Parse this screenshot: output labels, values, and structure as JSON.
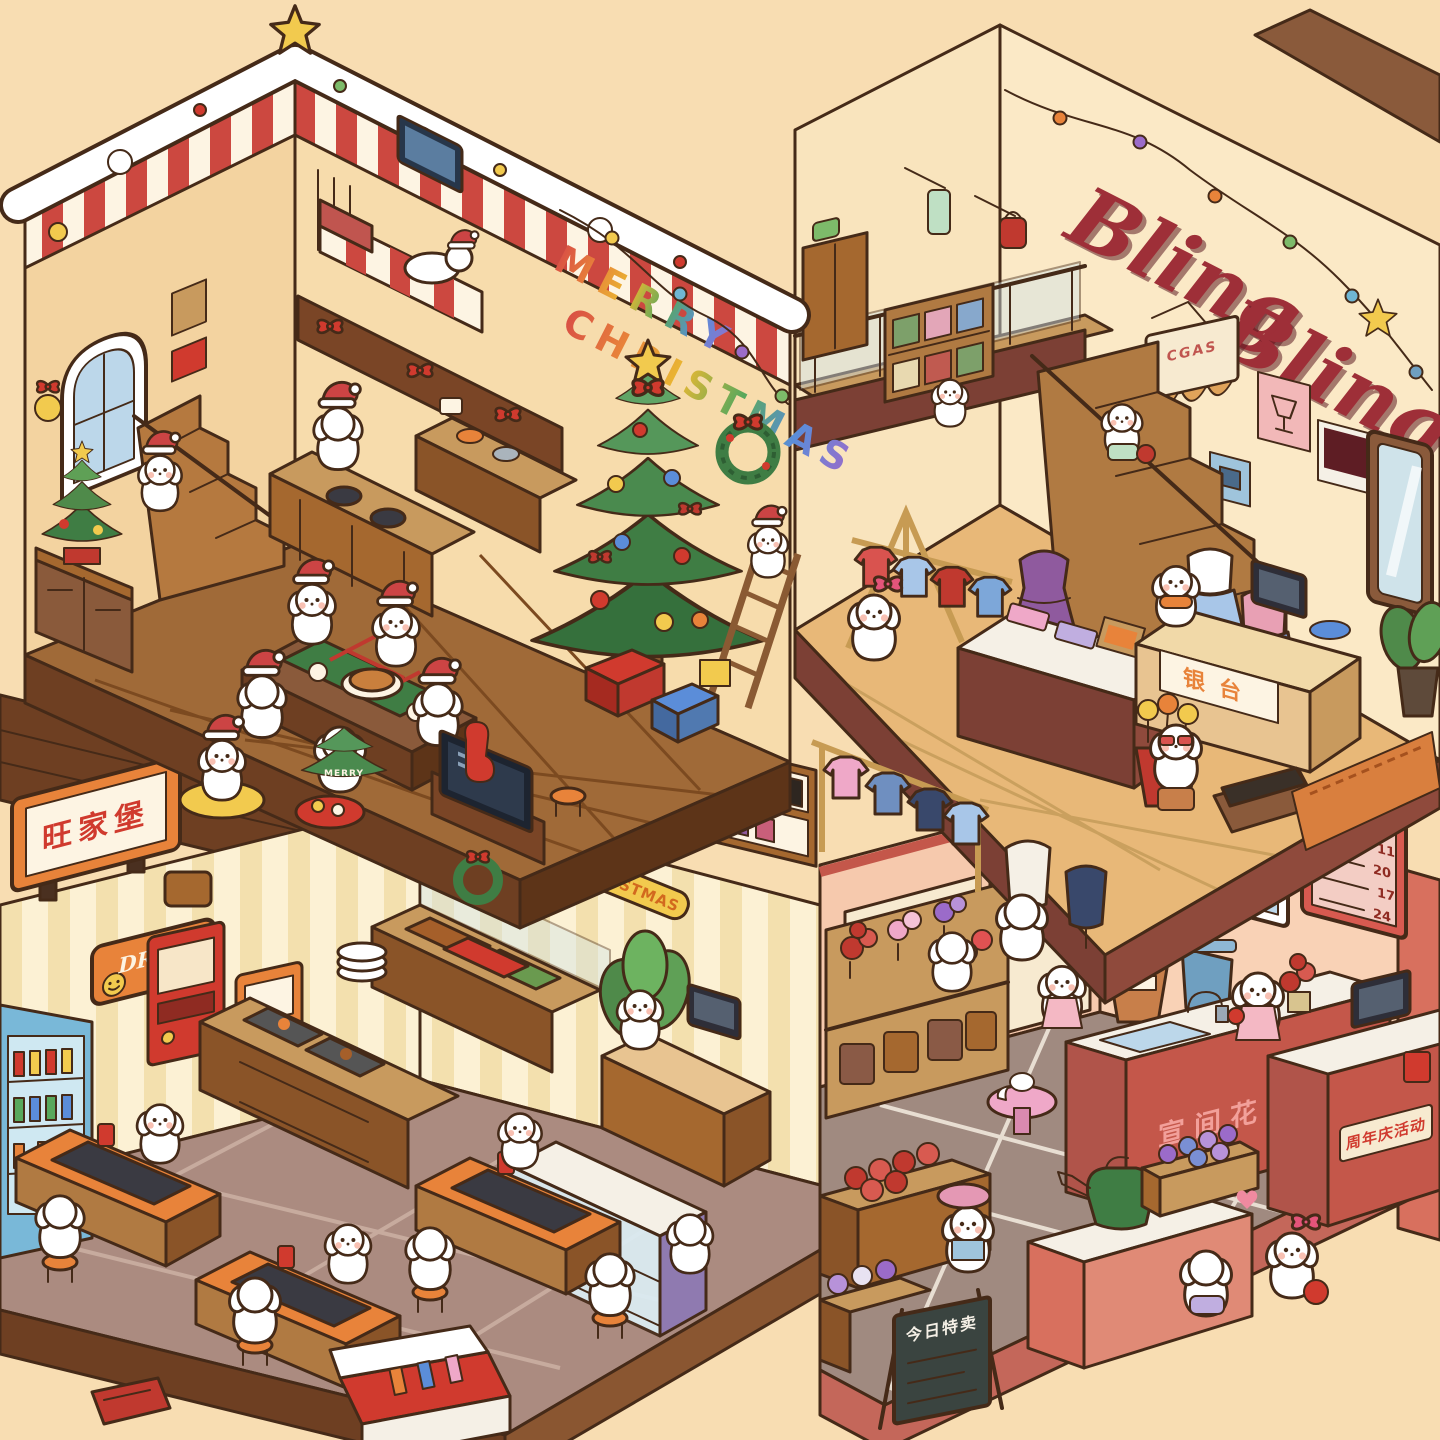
{
  "palette": {
    "background": "#f8ddb2",
    "outline": "#452a18",
    "candy_red": "#cc4840",
    "snow_white": "#ffffff",
    "wood_brown": "#9c6436",
    "cream": "#fdf2d8",
    "accent_orange": "#e8833a",
    "tree_green": "#3f7d44",
    "store_title_red": "#9e2f38",
    "flower_shop_red": "#c4574a"
  },
  "rooms": {
    "christmas_house": {
      "wall_text_line1": "MERRY",
      "wall_text_line2": "CHRISTMAS",
      "cookie_tree_text": "MERRY"
    },
    "clothing_store": {
      "title_line1": "Bling",
      "title_line2": "Bling",
      "hanging_banner_text": "CGAS",
      "cashier_sign": "银台"
    },
    "restaurant": {
      "roof_sign": "旺家堡",
      "drink_sign": "DRINK",
      "floor_banner": "MARRY CHRISTMAS"
    },
    "flower_shop": {
      "price_board_title": "价目表",
      "price_list": [
        "11",
        "20",
        "17",
        "24"
      ],
      "counter_banner": "宣间花庄",
      "promo_sign": "周年庆活动",
      "blackboard_sign": "今日特卖"
    }
  }
}
